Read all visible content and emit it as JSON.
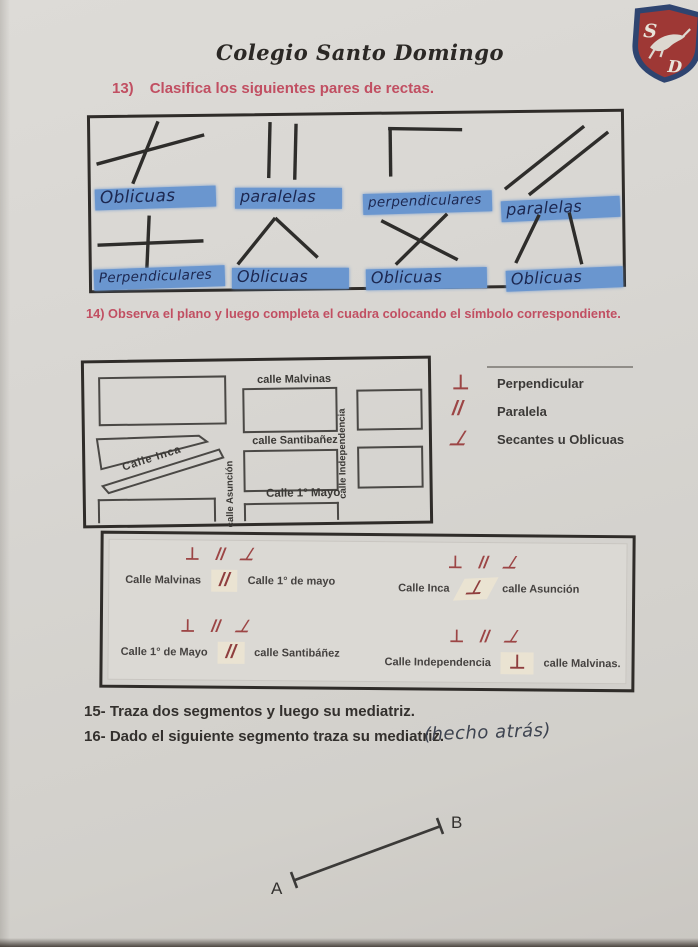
{
  "header": {
    "school_name": "Colegio Santo Domingo",
    "logo": {
      "letter_s": "S",
      "letter_d": "D"
    }
  },
  "q13": {
    "number": "13)",
    "title": "Clasifica los siguientes pares de rectas.",
    "items": [
      {
        "figure": "oblique-crossing-lines",
        "answer": "Oblicuas"
      },
      {
        "figure": "vertical-parallel-lines",
        "answer": "paralelas"
      },
      {
        "figure": "right-angle-corner-lines",
        "answer": "perpendiculares"
      },
      {
        "figure": "diagonal-parallel-lines",
        "answer": "paralelas"
      },
      {
        "figure": "plus-crossing-lines",
        "answer": "Perpendiculares"
      },
      {
        "figure": "caret-angle-lines",
        "answer": "Oblicuas"
      },
      {
        "figure": "x-crossing-lines",
        "answer": "Oblicuas"
      },
      {
        "figure": "slanted-and-vertical-lines",
        "answer": "Oblicuas"
      }
    ]
  },
  "q14": {
    "title": "14) Observa el plano y luego completa el cuadra colocando el símbolo correspondiente.",
    "map": {
      "street_malvinas": "calle Malvinas",
      "street_santibanez": "calle  Santibañez",
      "street_mayo": "Calle 1° Mayo",
      "street_inca": "Calle Inca",
      "street_asuncion": "calle Asunción",
      "street_independencia": "calle Independencia"
    },
    "legend": {
      "items": [
        {
          "symbol": "⊥",
          "label": "Perpendicular"
        },
        {
          "symbol": "//",
          "label": "Paralela"
        },
        {
          "symbol": "⊥",
          "label": "Secantes  u Oblicuas"
        }
      ]
    },
    "options": {
      "perp": "⊥",
      "para": "//",
      "obli": "⊥"
    },
    "answers": [
      {
        "left": "Calle Malvinas",
        "symbol": "//",
        "right": "Calle 1° de mayo"
      },
      {
        "left": "Calle Inca",
        "symbol": "⊥",
        "right": "calle Asunción"
      },
      {
        "left": "Calle 1° de Mayo",
        "symbol": "//",
        "right": "calle Santibáñez"
      },
      {
        "left": "Calle Independencia",
        "symbol": "⊥",
        "right": "calle Malvinas."
      }
    ]
  },
  "q15": {
    "text": "15- Traza dos segmentos y luego su mediatriz."
  },
  "q16": {
    "text": "16- Dado el siguiente segmento traza su mediatriz.",
    "note": "(hecho atrás)"
  },
  "segment": {
    "a": "A",
    "b": "B"
  }
}
